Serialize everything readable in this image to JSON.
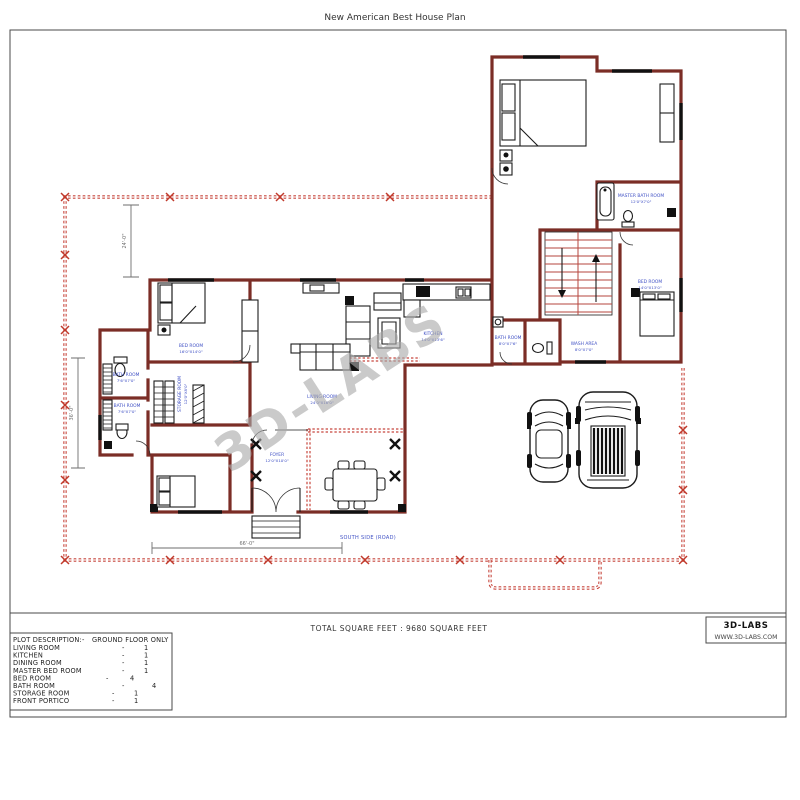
{
  "page": {
    "title": "New American Best House Plan"
  },
  "title_block": {
    "total_square_feet_text": "TOTAL SQUARE FEET : 9680 SQUARE FEET",
    "logo_name": "3D-LABS",
    "logo_website": "WWW.3D-LABS.COM"
  },
  "plot_description": {
    "header_label": "PLOT DESCRIPTION:-",
    "header_value": "GROUND FLOOR ONLY",
    "rows": [
      {
        "label": "LIVING ROOM",
        "dash": "-",
        "count": "1"
      },
      {
        "label": "KITCHEN",
        "dash": "-",
        "count": "1"
      },
      {
        "label": "DINING ROOM",
        "dash": "-",
        "count": "1"
      },
      {
        "label": "MASTER BED ROOM",
        "dash": "-",
        "count": "1"
      },
      {
        "label": "BED ROOM",
        "dash": "-",
        "count": "4"
      },
      {
        "label": "BATH ROOM",
        "dash": "-",
        "count": "4"
      },
      {
        "label": "STORAGE ROOM",
        "dash": "-",
        "count": "1"
      },
      {
        "label": "FRONT PORTICO",
        "dash": "-",
        "count": "1"
      }
    ]
  },
  "floor_plan": {
    "watermark": "3D-LABS",
    "road_label": "SOUTH SIDE (ROAD)",
    "labels": {
      "bed1": {
        "name": "BED ROOM",
        "size": "16'0\"X14'0\""
      },
      "bath1": {
        "name": "BATH ROOM",
        "size": "7'6\"X7'0\""
      },
      "bath2": {
        "name": "BATH ROOM",
        "size": "7'6\"X7'0\""
      },
      "storage": {
        "name": "STORAGE ROOM",
        "size": "12'0\"X8'0\""
      },
      "living": {
        "name": "LIVING ROOM",
        "size": "24'0\"X16'0\""
      },
      "kitchen": {
        "name": "KITCHEN",
        "size": "14'0\"X13'6\""
      },
      "common_bath": {
        "name": "BATH ROOM",
        "size": "8'0\"X7'6\""
      },
      "wash": {
        "name": "WASH AREA",
        "size": "8'0\"X7'0\""
      },
      "bed_right": {
        "name": "BED ROOM",
        "size": "14'0\"X13'0\""
      },
      "master_bath": {
        "name": "MASTER BATH ROOM",
        "size": "12'0\"X7'0\""
      },
      "foyer": {
        "name": "FOYER",
        "size": "12'0\"X10'0\""
      }
    },
    "dimensions": {
      "top_vertical": "24'-0\"",
      "left_vertical": "36'-0\"",
      "bottom_horizontal": "66'-0\""
    }
  },
  "colors": {
    "wall": "#7b2d26",
    "boundary": "#c7463d",
    "stairs": "#b5463e",
    "room_label": "#4051c5",
    "watermark": "#ababab",
    "dimension": "#6e6e6e"
  }
}
